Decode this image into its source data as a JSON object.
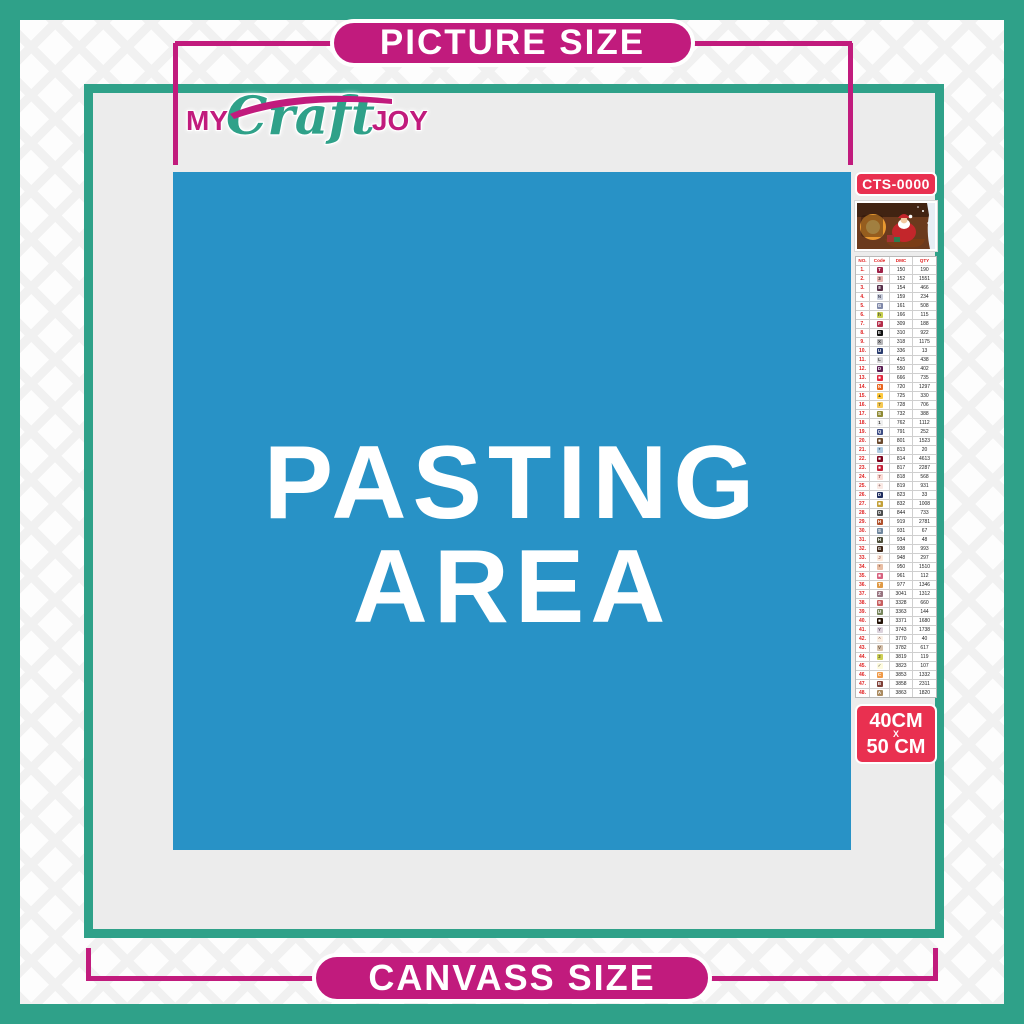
{
  "banners": {
    "top": "PICTURE SIZE",
    "bottom": "CANVASS SIZE"
  },
  "logo": {
    "my": "MY",
    "craft": "Craft",
    "joy": "JOY"
  },
  "pasting_area": {
    "line1": "PASTING",
    "line2": "AREA"
  },
  "product": {
    "code": "CTS-0000",
    "size_line1": "40CM",
    "size_line2": "X",
    "size_line3": "50 CM"
  },
  "colors": {
    "teal": "#2fa189",
    "magenta": "#c11b7d",
    "red_badge": "#e93050",
    "blue_area": "#2892c6",
    "canvas_gray": "#ececec",
    "white": "#ffffff"
  },
  "table": {
    "headers": [
      "NO.",
      "Code",
      "DMC",
      "QTY"
    ],
    "rows": [
      {
        "n": "1.",
        "s": "T",
        "c": "#a02349",
        "f": "#fff",
        "d": "150",
        "q": "190"
      },
      {
        "n": "2.",
        "s": "3",
        "c": "#e8b4b0",
        "f": "#333",
        "d": "152",
        "q": "1551"
      },
      {
        "n": "3.",
        "s": "8",
        "c": "#57304a",
        "f": "#fff",
        "d": "154",
        "q": "466"
      },
      {
        "n": "4.",
        "s": "N",
        "c": "#c9cedc",
        "f": "#445",
        "d": "159",
        "q": "234"
      },
      {
        "n": "5.",
        "s": "G",
        "c": "#8089a9",
        "f": "#fff",
        "d": "161",
        "q": "508"
      },
      {
        "n": "6.",
        "s": "h",
        "c": "#c8d04f",
        "f": "#333",
        "d": "166",
        "q": "115"
      },
      {
        "n": "7.",
        "s": "F",
        "c": "#b42d49",
        "f": "#fff",
        "d": "309",
        "q": "188"
      },
      {
        "n": "8.",
        "s": "E",
        "c": "#111111",
        "f": "#fff",
        "d": "310",
        "q": "922"
      },
      {
        "n": "9.",
        "s": "X",
        "c": "#b5b5b8",
        "f": "#333",
        "d": "318",
        "q": "1175"
      },
      {
        "n": "10.",
        "s": "U",
        "c": "#2a3c6e",
        "f": "#fff",
        "d": "336",
        "q": "13"
      },
      {
        "n": "11.",
        "s": "L",
        "c": "#d8d8da",
        "f": "#333",
        "d": "415",
        "q": "438"
      },
      {
        "n": "12.",
        "s": "D",
        "c": "#5b1d52",
        "f": "#fff",
        "d": "550",
        "q": "402"
      },
      {
        "n": "13.",
        "s": "■",
        "c": "#e2293f",
        "f": "#fff",
        "d": "666",
        "q": "735"
      },
      {
        "n": "14.",
        "s": "N",
        "c": "#e9661f",
        "f": "#fff",
        "d": "720",
        "q": "1297"
      },
      {
        "n": "15.",
        "s": "▲",
        "c": "#ffc93e",
        "f": "#553",
        "d": "725",
        "q": "330"
      },
      {
        "n": "16.",
        "s": "7",
        "c": "#f6c954",
        "f": "#553",
        "d": "728",
        "q": "706"
      },
      {
        "n": "17.",
        "s": "S",
        "c": "#8f8a35",
        "f": "#fff",
        "d": "732",
        "q": "388"
      },
      {
        "n": "18.",
        "s": "1",
        "c": "#efefef",
        "f": "#333",
        "d": "762",
        "q": "1112"
      },
      {
        "n": "19.",
        "s": "Q",
        "c": "#3c4c84",
        "f": "#fff",
        "d": "791",
        "q": "252"
      },
      {
        "n": "20.",
        "s": "■",
        "c": "#6b4a2e",
        "f": "#fff",
        "d": "801",
        "q": "1523"
      },
      {
        "n": "21.",
        "s": "*",
        "c": "#aecbe2",
        "f": "#345",
        "d": "813",
        "q": "20"
      },
      {
        "n": "22.",
        "s": "■",
        "c": "#80041e",
        "f": "#fff",
        "d": "814",
        "q": "4613"
      },
      {
        "n": "23.",
        "s": "■",
        "c": "#c42138",
        "f": "#fff",
        "d": "817",
        "q": "2287"
      },
      {
        "n": "24.",
        "s": "7",
        "c": "#fbdcd6",
        "f": "#844",
        "d": "818",
        "q": "568"
      },
      {
        "n": "25.",
        "s": "+",
        "c": "#fae9e4",
        "f": "#866",
        "d": "819",
        "q": "931"
      },
      {
        "n": "26.",
        "s": "D",
        "c": "#1f2d5e",
        "f": "#fff",
        "d": "823",
        "q": "33"
      },
      {
        "n": "27.",
        "s": "■",
        "c": "#c3a038",
        "f": "#fff",
        "d": "832",
        "q": "1008"
      },
      {
        "n": "28.",
        "s": "O",
        "c": "#4c4c4c",
        "f": "#fff",
        "d": "844",
        "q": "733"
      },
      {
        "n": "29.",
        "s": "H",
        "c": "#b0512b",
        "f": "#fff",
        "d": "919",
        "q": "2781"
      },
      {
        "n": "30.",
        "s": "S",
        "c": "#70879e",
        "f": "#fff",
        "d": "931",
        "q": "67"
      },
      {
        "n": "31.",
        "s": "H",
        "c": "#50513c",
        "f": "#fff",
        "d": "934",
        "q": "48"
      },
      {
        "n": "32.",
        "s": "G",
        "c": "#42291a",
        "f": "#fff",
        "d": "938",
        "q": "993"
      },
      {
        "n": "33.",
        "s": "J",
        "c": "#fde9da",
        "f": "#966",
        "d": "948",
        "q": "297"
      },
      {
        "n": "34.",
        "s": "*",
        "c": "#e9bea4",
        "f": "#754",
        "d": "950",
        "q": "1510"
      },
      {
        "n": "35.",
        "s": "■",
        "c": "#d8617f",
        "f": "#fff",
        "d": "961",
        "q": "112"
      },
      {
        "n": "36.",
        "s": "T",
        "c": "#e09a45",
        "f": "#fff",
        "d": "977",
        "q": "1346"
      },
      {
        "n": "37.",
        "s": "Z",
        "c": "#97737f",
        "f": "#fff",
        "d": "3041",
        "q": "1312"
      },
      {
        "n": "38.",
        "s": "9",
        "c": "#c75f5f",
        "f": "#fff",
        "d": "3328",
        "q": "660"
      },
      {
        "n": "39.",
        "s": "U",
        "c": "#77855b",
        "f": "#fff",
        "d": "3363",
        "q": "144"
      },
      {
        "n": "40.",
        "s": "■",
        "c": "#241307",
        "f": "#fff",
        "d": "3371",
        "q": "1680"
      },
      {
        "n": "41.",
        "s": "Y",
        "c": "#dcd2dc",
        "f": "#656",
        "d": "3743",
        "q": "1738"
      },
      {
        "n": "42.",
        "s": "^",
        "c": "#fbefe4",
        "f": "#976",
        "d": "3770",
        "q": "40"
      },
      {
        "n": "43.",
        "s": "V",
        "c": "#d6c1ab",
        "f": "#654",
        "d": "3782",
        "q": "617"
      },
      {
        "n": "44.",
        "s": "2",
        "c": "#cfd158",
        "f": "#553",
        "d": "3819",
        "q": "119"
      },
      {
        "n": "45.",
        "s": "✓",
        "c": "#fefbde",
        "f": "#887",
        "d": "3823",
        "q": "107"
      },
      {
        "n": "46.",
        "s": "C",
        "c": "#f09a48",
        "f": "#fff",
        "d": "3853",
        "q": "1332"
      },
      {
        "n": "47.",
        "s": "B",
        "c": "#7f4038",
        "f": "#fff",
        "d": "3858",
        "q": "2311"
      },
      {
        "n": "48.",
        "s": "A",
        "c": "#aa8a60",
        "f": "#fff",
        "d": "3863",
        "q": "1820"
      }
    ]
  }
}
